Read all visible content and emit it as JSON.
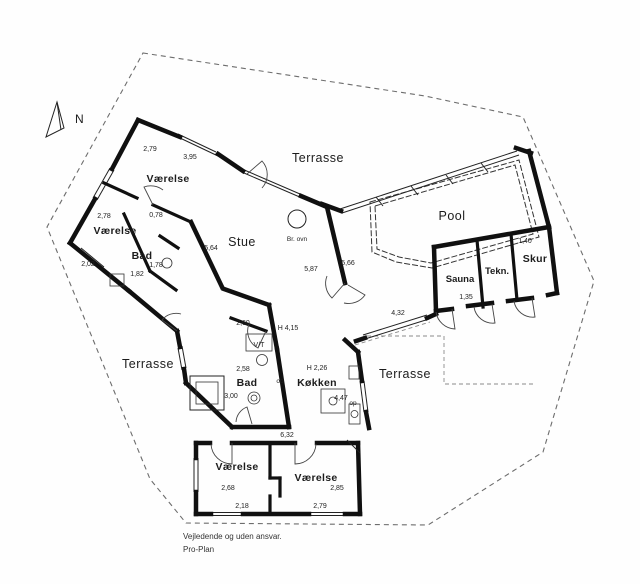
{
  "t": {
    "north": "N",
    "terrasse_top": "Terrasse",
    "terrasse_left": "Terrasse",
    "terrasse_right": "Terrasse",
    "vaerelse_nw": "Værelse",
    "vaerelse_w": "Værelse",
    "bad_w": "Bad",
    "stue": "Stue",
    "br_ovn": "Br. ovn",
    "pool": "Pool",
    "sauna": "Sauna",
    "tekn": "Tekn.",
    "skur": "Skur",
    "vt": "V/T",
    "bad_c": "Bad",
    "koekken": "Køkken",
    "op_a": "op",
    "op_b": "op",
    "vaerelse_s1": "Værelse",
    "vaerelse_s2": "Værelse",
    "m_279": "2,79",
    "m_395": "3,95",
    "m_278": "2,78",
    "m_078": "0,78",
    "m_178": "1,78",
    "m_182": "1,82",
    "m_202": "2,02",
    "m_564": "5,64",
    "m_587": "5,87",
    "m_566": "5,66",
    "m_432": "4,32",
    "m_135": "1,35",
    "m_140": "1,40",
    "m_260": "2,60",
    "m_h415": "H 4,15",
    "m_258": "2,58",
    "m_300": "3,00",
    "m_h226": "H 2,26",
    "m_447": "4,47",
    "m_632": "6,32",
    "m_268": "2,68",
    "m_218": "2,18",
    "m_285": "2,85",
    "m_279b": "2,79",
    "footer1": "Vejledende og uden ansvar.",
    "footer2": "Pro-Plan"
  },
  "colors": {
    "wall": "#101010",
    "boundary": "#6d6d6d",
    "text": "#1c1c1c"
  }
}
